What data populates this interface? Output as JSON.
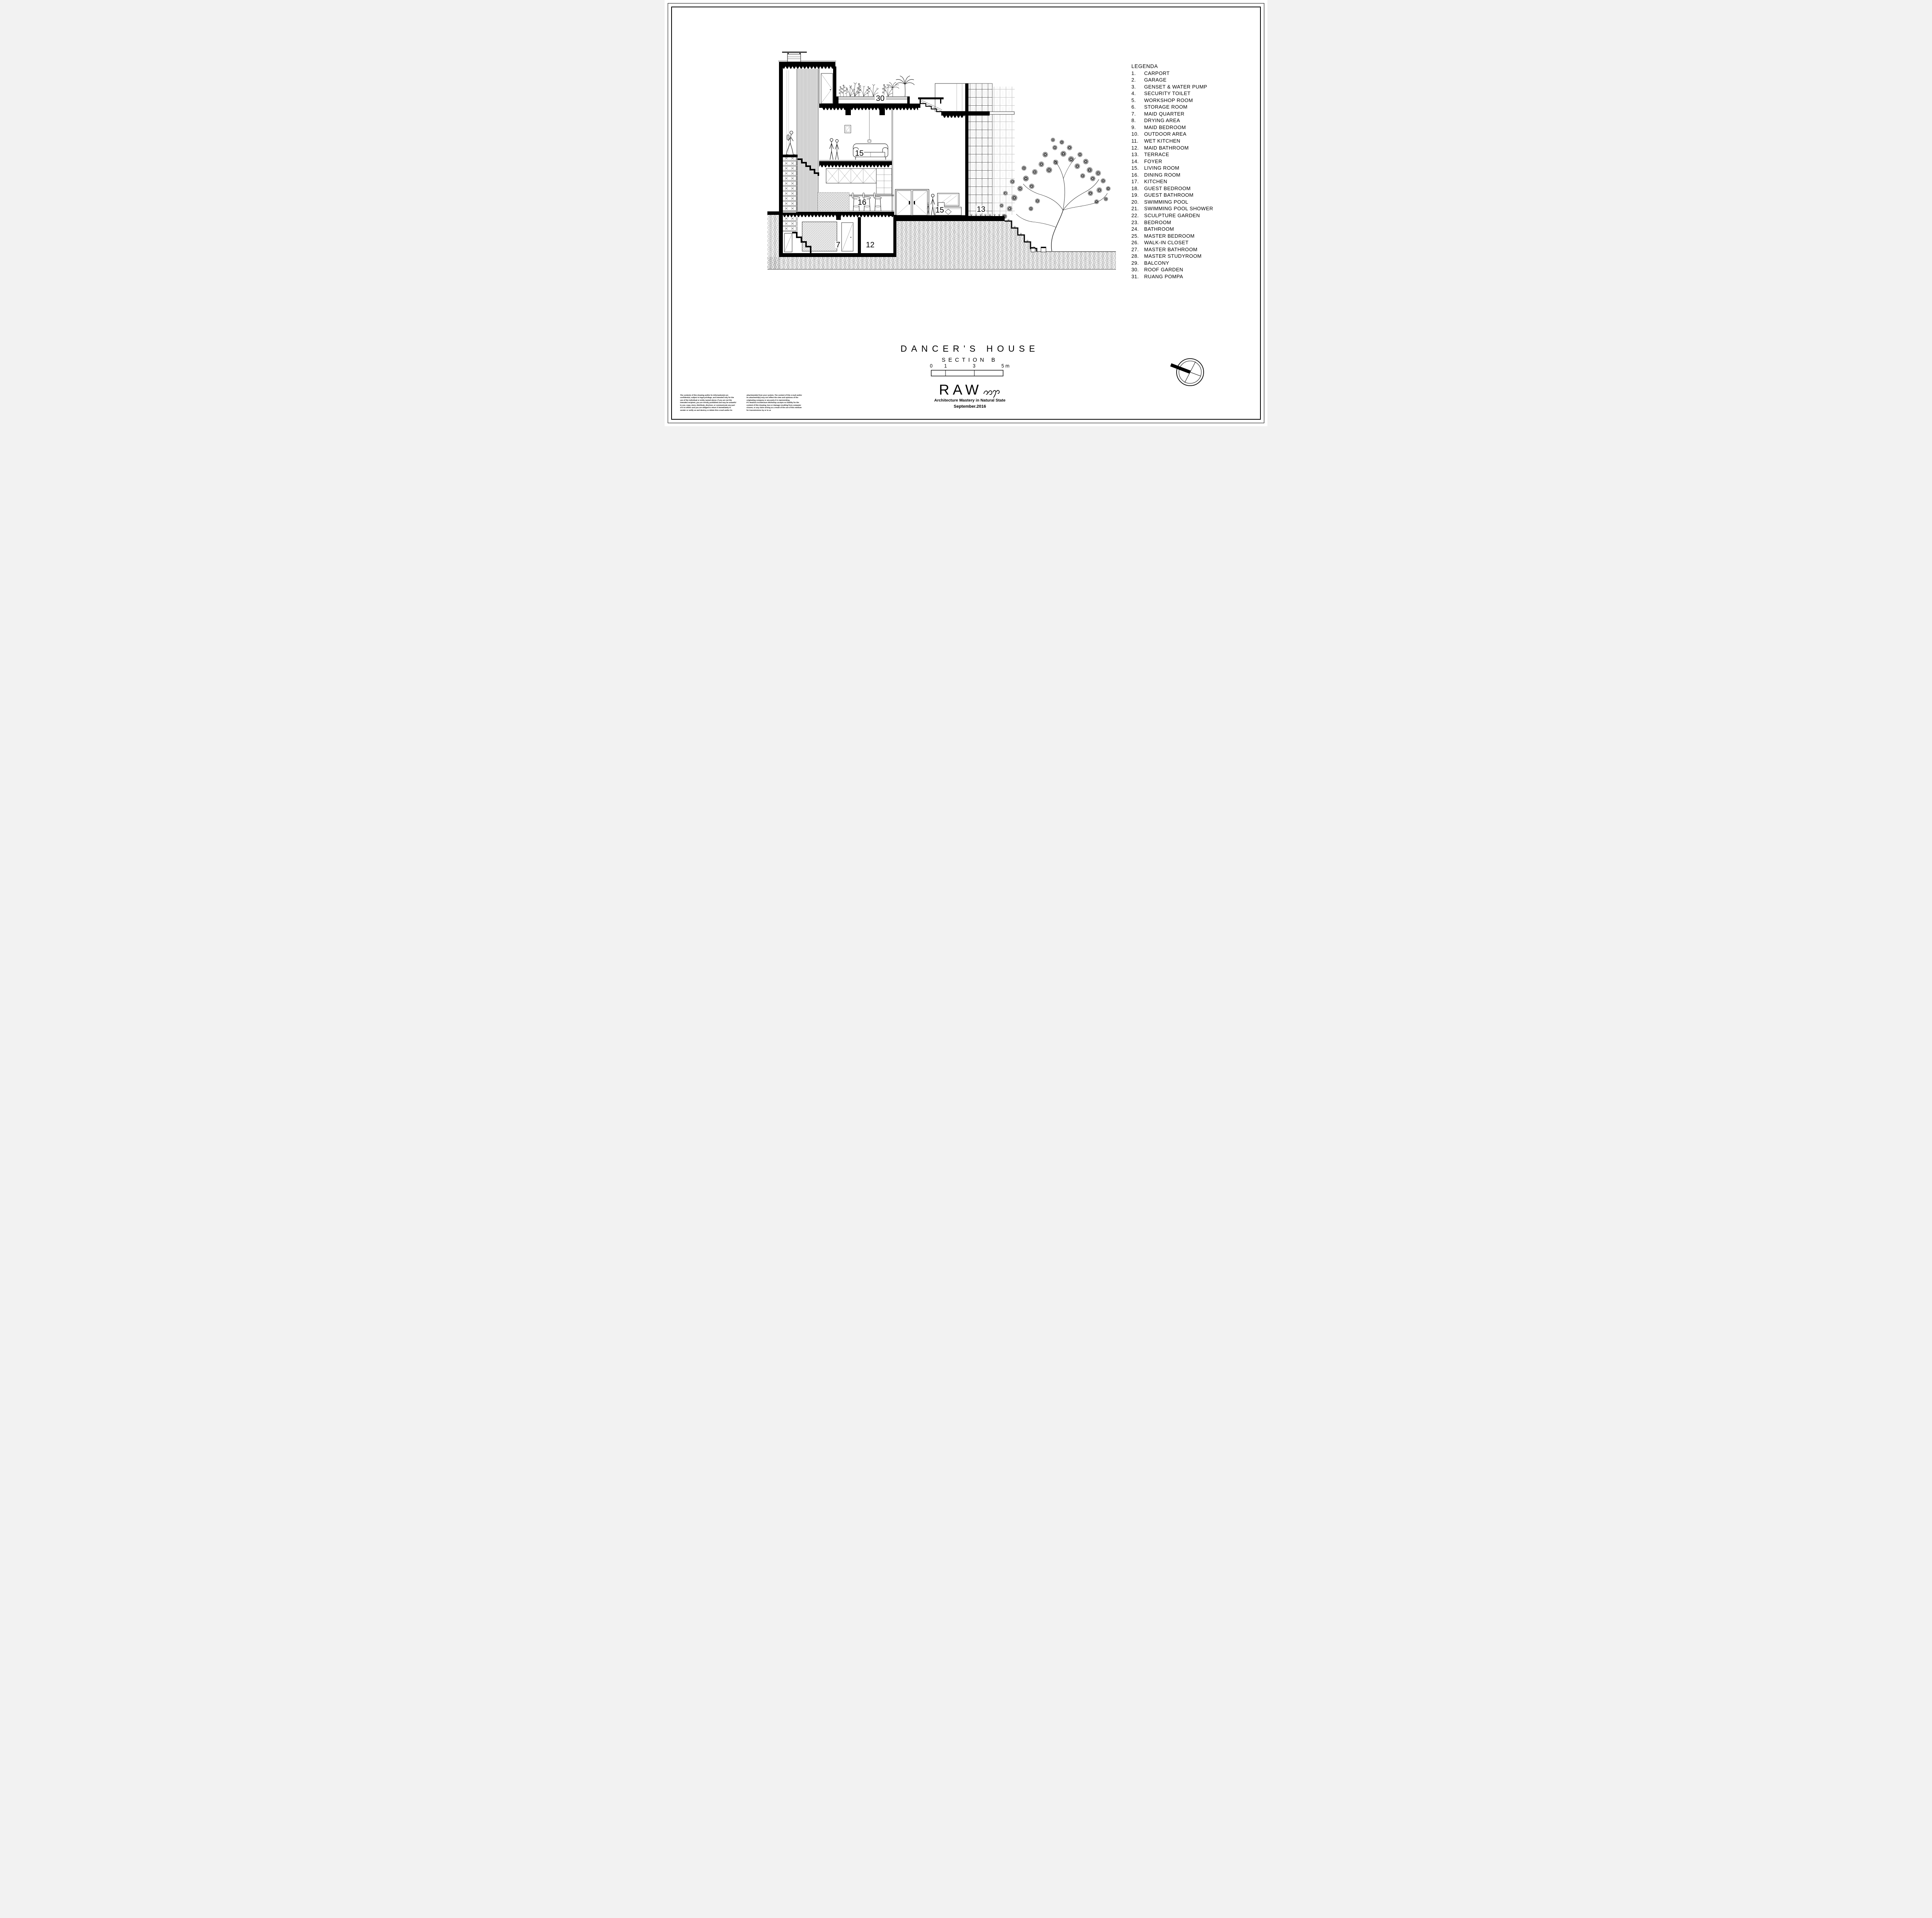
{
  "sheet": {
    "paper_color": "#ffffff",
    "line_color": "#000000"
  },
  "legend": {
    "title": "LEGENDA",
    "items": [
      {
        "num": "1.",
        "label": "CARPORT"
      },
      {
        "num": "2.",
        "label": "GARAGE"
      },
      {
        "num": "3.",
        "label": "GENSET & WATER PUMP"
      },
      {
        "num": "4.",
        "label": "SECURITY TOILET"
      },
      {
        "num": "5.",
        "label": "WORKSHOP ROOM"
      },
      {
        "num": "6.",
        "label": "STORAGE ROOM"
      },
      {
        "num": "7.",
        "label": "MAID QUARTER"
      },
      {
        "num": "8.",
        "label": "DRYING AREA"
      },
      {
        "num": "9.",
        "label": "MAID BEDROOM"
      },
      {
        "num": "10.",
        "label": "OUTDOOR AREA"
      },
      {
        "num": "11.",
        "label": "WET KITCHEN"
      },
      {
        "num": "12.",
        "label": "MAID BATHROOM"
      },
      {
        "num": "13.",
        "label": "TERRACE"
      },
      {
        "num": "14.",
        "label": "FOYER"
      },
      {
        "num": "15.",
        "label": "LIVING ROOM"
      },
      {
        "num": "16.",
        "label": "DINING ROOM"
      },
      {
        "num": "17.",
        "label": "KITCHEN"
      },
      {
        "num": "18.",
        "label": "GUEST BEDROOM"
      },
      {
        "num": "19.",
        "label": "GUEST BATHROOM"
      },
      {
        "num": "20.",
        "label": "SWIMMING POOL"
      },
      {
        "num": "21.",
        "label": "SWIMMING POOL SHOWER"
      },
      {
        "num": "22.",
        "label": "SCULPTURE GARDEN"
      },
      {
        "num": "23.",
        "label": "BEDROOM"
      },
      {
        "num": "24.",
        "label": "BATHROOM"
      },
      {
        "num": "25.",
        "label": "MASTER BEDROOM"
      },
      {
        "num": "26.",
        "label": "WALK-IN CLOSET"
      },
      {
        "num": "27.",
        "label": "MASTER BATHROOM"
      },
      {
        "num": "28.",
        "label": "MASTER STUDYROOM"
      },
      {
        "num": "29.",
        "label": "BALCONY"
      },
      {
        "num": "30.",
        "label": "ROOF GARDEN"
      },
      {
        "num": "31.",
        "label": "RUANG POMPA"
      }
    ]
  },
  "drawing": {
    "labels": {
      "roof_garden": "30",
      "living_room": "15",
      "dining_room": "16",
      "foyer": "15",
      "terrace": "13",
      "maid_quarter": "7",
      "maid_bathroom": "12"
    }
  },
  "title_block": {
    "project": "DANCER'S HOUSE",
    "drawing": "SECTION B"
  },
  "scale_bar": {
    "labels": [
      "0",
      "1",
      "3",
      "5 m"
    ]
  },
  "logo": {
    "wordmark": "RAW",
    "tagline": "Architecture Mastery in Natural State",
    "date": "September.2016"
  },
  "disclaimer": {
    "left": "The contents of this drawing and/or its information(s) are\nconfidential, subject to legal privilege, and intended only for the\nuse of the individual or entity named above.  If you are not the\nintended recipient, you are strictly prohibited and may be unlawful\nto use, copy, store, distribute, disclose, or communicate any part\nof it to others and you are obliged to return it immediately to\nsender or notify us and destroy or delete this e-mail and/or its",
    "right": "attachment(s) from your system.  The content of this e-mail and/or\nits attachment(s) may not reflect the view and opinions of the\noriginating company or any party it is representing.\nPT. Realrich Architecture Workshop accepts no liability for the\ncontent of this drawing, loss or damage resulting from computer\nviruses, or any claim arising as a result of the use of this medium\nfor transmissions by or to us"
  }
}
